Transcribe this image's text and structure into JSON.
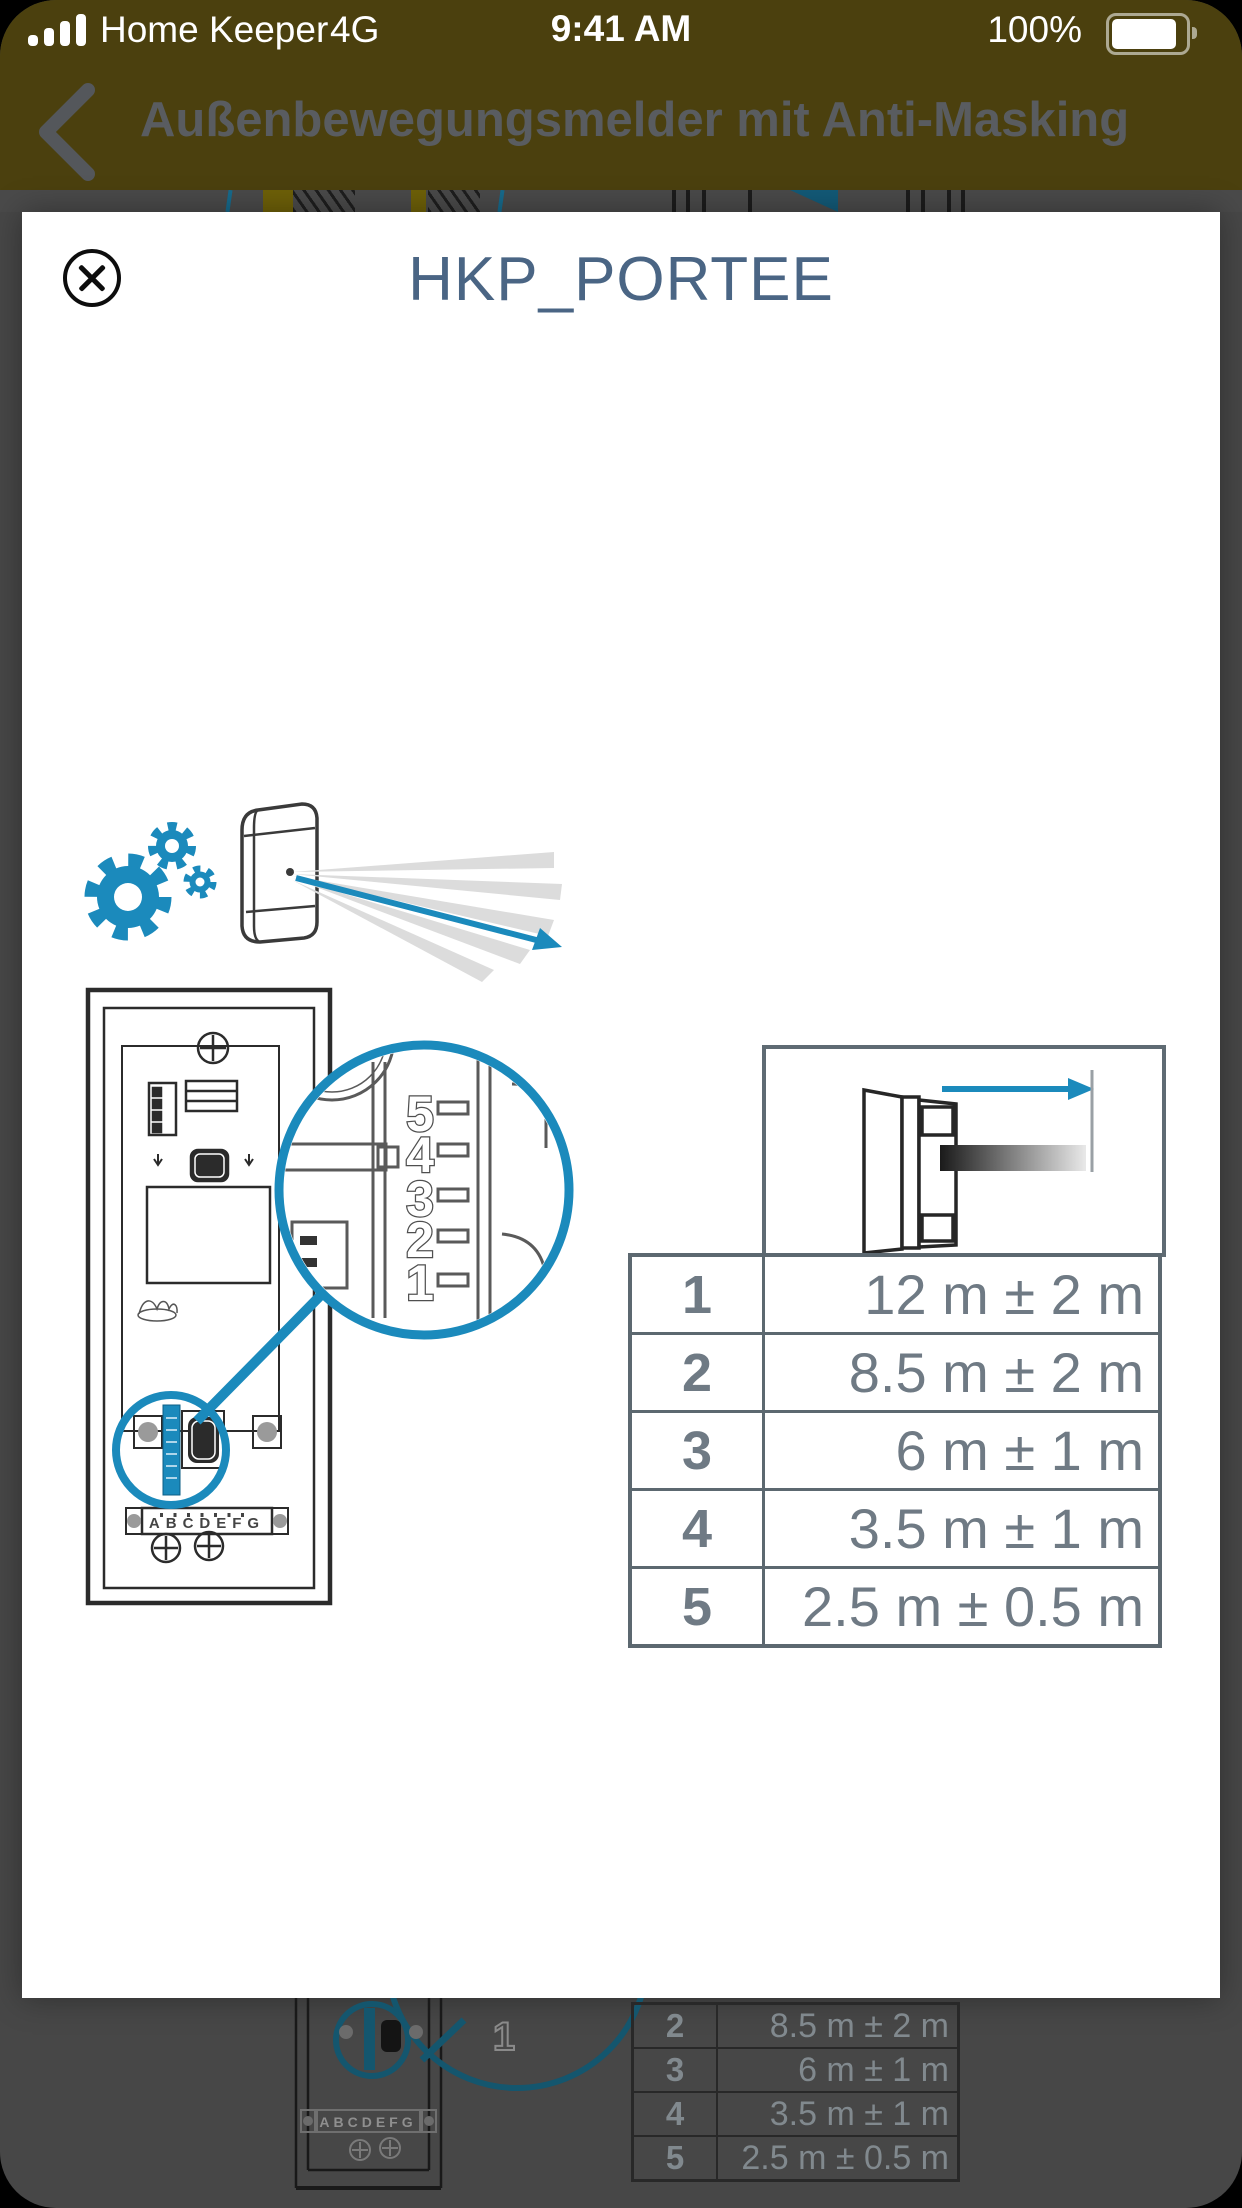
{
  "status_bar": {
    "carrier": "Home Keeper",
    "network": "4G",
    "time": "9:41 AM",
    "battery_percent": "100%"
  },
  "nav_bar": {
    "title": "Außenbewegungsmelder mit Anti-Masking"
  },
  "modal": {
    "title": "HKP_PORTEE",
    "diagram": {
      "callout_digits": [
        "5",
        "4",
        "3",
        "2",
        "1"
      ],
      "terminal_labels": "ABCDEFG"
    },
    "range_table": {
      "rows": [
        {
          "level": "1",
          "range": "12 m ± 2 m"
        },
        {
          "level": "2",
          "range": "8.5 m ± 2 m"
        },
        {
          "level": "3",
          "range": "6 m ± 1 m"
        },
        {
          "level": "4",
          "range": "3.5 m ± 1 m"
        },
        {
          "level": "5",
          "range": "2.5 m ± 0.5 m"
        }
      ]
    }
  },
  "background_page": {
    "callout_digit": "1",
    "terminal_labels": "ABCDEFG",
    "partial_table_rows": [
      {
        "level": "2",
        "range": "8.5 m ± 2 m"
      },
      {
        "level": "3",
        "range": "6 m ± 1 m"
      },
      {
        "level": "4",
        "range": "3.5 m ± 1 m"
      },
      {
        "level": "5",
        "range": "2.5 m ± 0.5 m"
      }
    ]
  },
  "colors": {
    "accent_blue": "#1b8abc",
    "header_olive": "#4b400e",
    "modal_title_blue": "#4a6584",
    "table_gray": "#6f7a84"
  }
}
